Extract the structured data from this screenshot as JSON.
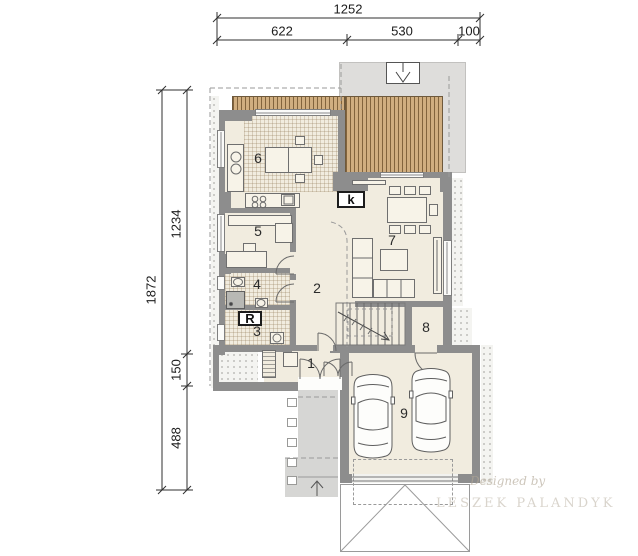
{
  "dimensions": {
    "top": {
      "total": "1252",
      "segments": [
        "622",
        "530",
        "100"
      ]
    },
    "left": {
      "total": "1872",
      "segments": [
        "1234",
        "150",
        "488"
      ]
    }
  },
  "rooms": {
    "r1": "1",
    "r2": "2",
    "r3": "3",
    "r4": "4",
    "r5": "5",
    "r6": "6",
    "r7": "7",
    "r8": "8",
    "r9": "9"
  },
  "markers": {
    "fireplace_label": "k",
    "boiler_label": "R"
  },
  "watermark": {
    "line1": "Designed by",
    "line2": "LESZEK PALANDYK"
  },
  "colors": {
    "wall": "#8d8d8d",
    "floor": "#f1ecdf",
    "deck_base": "#d0ae80",
    "deck_stripe": "#7a5c36",
    "outside_gray": "#dedddb",
    "path_gray": "#d6d6d4",
    "dash_line": "#9a9a9a"
  }
}
